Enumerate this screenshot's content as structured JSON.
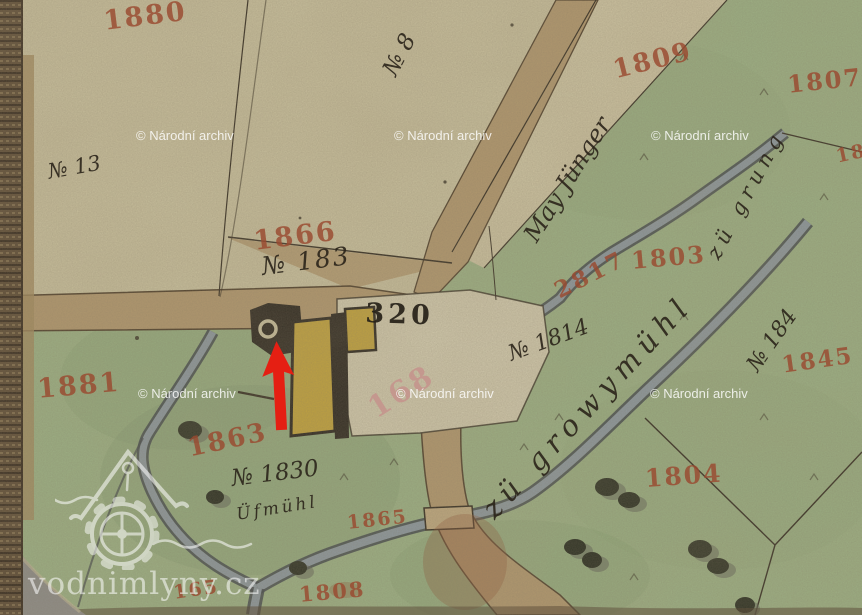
{
  "watermark": {
    "archive": "© Národní archiv",
    "site": "vodnimlyny.cz"
  },
  "labels": {
    "red_1880": "1880",
    "no_8": "№ 8",
    "no_13": "№ 13",
    "red_1809": "1809",
    "red_1807": "1807",
    "red_180_frag": "180",
    "may_junger": "May Jünger",
    "zu_grung": "zü grung",
    "red_1866": "1866",
    "no_183": "№ 183",
    "num_320": "320",
    "pink_168": "168",
    "red_2817": "2817",
    "red_1803": "1803",
    "no_1814": "№ 1814",
    "zu_growymuhl": "zü growymühl",
    "no_184": "№ 184",
    "red_1845": "1845",
    "red_1881": "1881",
    "red_1863": "1863",
    "no_1830": "№ 1830",
    "ufmuhl": "Üfmühl",
    "red_1865": "1865",
    "red_1804": "1804",
    "red_1808": "1808",
    "red_165": "165"
  },
  "colors": {
    "paper_beige": "#cfc7a3",
    "meadow_green": "#9db687",
    "road_tan": "#b59a6e",
    "stream_gray": "#8795a0",
    "ink_black": "#2b241a",
    "number_red": "#9a4a30",
    "building_yellow": "#c7a636",
    "marker_red": "#e51f13",
    "watermark_white": "#ffffff"
  }
}
